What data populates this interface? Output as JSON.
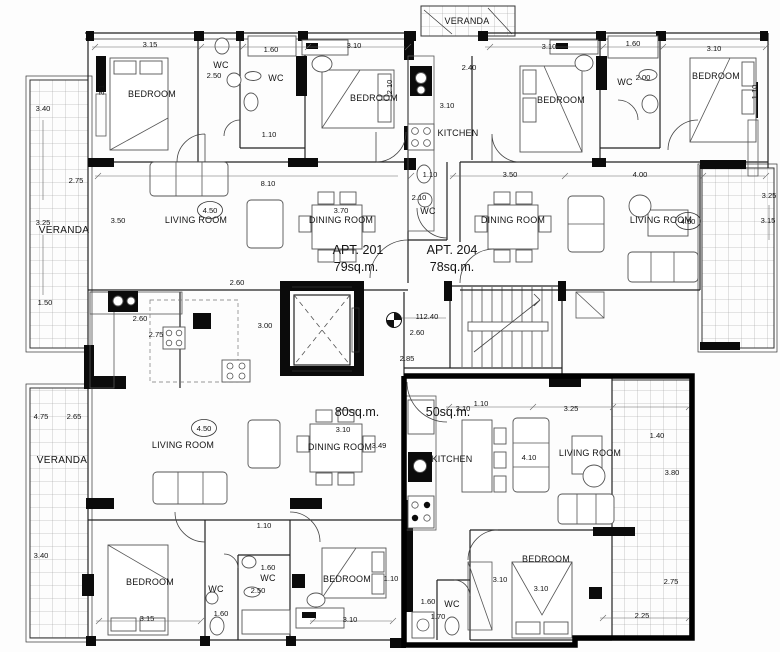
{
  "drawing": {
    "type": "architectural-floor-plan",
    "highlight_color": "#000000",
    "apartments": [
      {
        "id": "apt-201",
        "label": "APT. 201",
        "area": "79sq.m."
      },
      {
        "id": "apt-204",
        "label": "APT. 204",
        "area": "78sq.m."
      },
      {
        "id": "apt-bottom-left",
        "area": "80sq.m."
      },
      {
        "id": "apt-bottom-right",
        "area": "50sq.m.",
        "highlighted": true
      }
    ],
    "level_marker": {
      "value": "112.40"
    },
    "labels": [
      {
        "n": "bedroom-top-left",
        "t": "BEDROOM",
        "x": 152,
        "y": 97,
        "c": "room"
      },
      {
        "n": "wc-top-left",
        "t": "WC",
        "x": 221,
        "y": 68,
        "c": "room"
      },
      {
        "n": "wc-top-left-2",
        "t": "WC",
        "x": 276,
        "y": 81,
        "c": "room"
      },
      {
        "n": "bedroom-top-mid-left",
        "t": "BEDROOM",
        "x": 374,
        "y": 101,
        "c": "room"
      },
      {
        "n": "veranda-top",
        "t": "VERANDA",
        "x": 467,
        "y": 24,
        "c": "room"
      },
      {
        "n": "kitchen-top",
        "t": "KITCHEN",
        "x": 458,
        "y": 136,
        "c": "room"
      },
      {
        "n": "bedroom-top-mid-right",
        "t": "BEDROOM",
        "x": 561,
        "y": 103,
        "c": "room"
      },
      {
        "n": "wc-top-right",
        "t": "WC",
        "x": 625,
        "y": 85,
        "c": "room"
      },
      {
        "n": "bedroom-top-right",
        "t": "BEDROOM",
        "x": 716,
        "y": 79,
        "c": "room"
      },
      {
        "n": "veranda-left-top",
        "t": "VERANDA",
        "x": 64,
        "y": 233,
        "c": "ver"
      },
      {
        "n": "living-room-apt201",
        "t": "LIVING ROOM",
        "x": 196,
        "y": 223,
        "c": "room"
      },
      {
        "n": "dining-room-apt201",
        "t": "DINING ROOM",
        "x": 341,
        "y": 223,
        "c": "room"
      },
      {
        "n": "dining-room-apt204",
        "t": "DINING ROOM",
        "x": 513,
        "y": 223,
        "c": "room"
      },
      {
        "n": "living-room-apt204",
        "t": "LIVING ROOM",
        "x": 661,
        "y": 223,
        "c": "room"
      },
      {
        "n": "wc-apt204-hall",
        "t": "WC",
        "x": 428,
        "y": 214,
        "c": "room"
      },
      {
        "n": "veranda-left-bottom",
        "t": "VERANDA",
        "x": 62,
        "y": 463,
        "c": "ver"
      },
      {
        "n": "living-room-apt-bl",
        "t": "LIVING ROOM",
        "x": 183,
        "y": 448,
        "c": "room"
      },
      {
        "n": "dining-room-apt-bl",
        "t": "DINING ROOM",
        "x": 340,
        "y": 450,
        "c": "room"
      },
      {
        "n": "kitchen-apt-br",
        "t": "KITCHEN",
        "x": 452,
        "y": 462,
        "c": "room"
      },
      {
        "n": "living-room-apt-br",
        "t": "LIVING ROOM",
        "x": 590,
        "y": 456,
        "c": "room"
      },
      {
        "n": "bedroom-bottom-left",
        "t": "BEDROOM",
        "x": 150,
        "y": 585,
        "c": "room"
      },
      {
        "n": "wc-bottom-1",
        "t": "WC",
        "x": 216,
        "y": 592,
        "c": "room"
      },
      {
        "n": "wc-bottom-2",
        "t": "WC",
        "x": 268,
        "y": 581,
        "c": "room"
      },
      {
        "n": "bedroom-bottom-mid",
        "t": "BEDROOM",
        "x": 347,
        "y": 582,
        "c": "room"
      },
      {
        "n": "wc-bottom-3",
        "t": "WC",
        "x": 452,
        "y": 607,
        "c": "room"
      },
      {
        "n": "bedroom-bottom-right",
        "t": "BEDROOM",
        "x": 546,
        "y": 562,
        "c": "room"
      },
      {
        "n": "apt-201-label",
        "t": "APT. 201",
        "x": 358,
        "y": 254,
        "c": "apt"
      },
      {
        "n": "apt-201-area",
        "t": "79sq.m.",
        "x": 356,
        "y": 271,
        "c": "apt"
      },
      {
        "n": "apt-204-label",
        "t": "APT. 204",
        "x": 452,
        "y": 254,
        "c": "apt"
      },
      {
        "n": "apt-204-area",
        "t": "78sq.m.",
        "x": 452,
        "y": 271,
        "c": "apt"
      },
      {
        "n": "apt-bl-area",
        "t": "80sq.m.",
        "x": 357,
        "y": 416,
        "c": "apt"
      },
      {
        "n": "apt-br-area",
        "t": "50sq.m.",
        "x": 448,
        "y": 416,
        "c": "apt"
      },
      {
        "t": "3.15",
        "x": 150,
        "y": 47,
        "c": "dim"
      },
      {
        "t": "1.60",
        "x": 271,
        "y": 52,
        "c": "dim"
      },
      {
        "t": "3.10",
        "x": 354,
        "y": 48,
        "c": "dim"
      },
      {
        "t": "2.50",
        "x": 214,
        "y": 78,
        "c": "dim"
      },
      {
        "t": "2.40",
        "x": 469,
        "y": 70,
        "c": "dim"
      },
      {
        "t": "3.10",
        "x": 447,
        "y": 108,
        "c": "dim"
      },
      {
        "t": "2.10",
        "x": 392,
        "y": 87,
        "c": "dim",
        "r": -90
      },
      {
        "t": "3.1",
        "x": 104,
        "y": 90,
        "c": "dim",
        "r": -90
      },
      {
        "t": "3.10",
        "x": 549,
        "y": 49,
        "c": "dim"
      },
      {
        "t": "1.60",
        "x": 633,
        "y": 46,
        "c": "dim"
      },
      {
        "t": "2.00",
        "x": 643,
        "y": 80,
        "c": "dim"
      },
      {
        "t": "3.10",
        "x": 714,
        "y": 51,
        "c": "dim"
      },
      {
        "t": "1.10",
        "x": 757,
        "y": 92,
        "c": "dim",
        "r": -90
      },
      {
        "t": "3.40",
        "x": 43,
        "y": 111,
        "c": "dim"
      },
      {
        "t": "2.75",
        "x": 76,
        "y": 183,
        "c": "dim"
      },
      {
        "t": "3.25",
        "x": 43,
        "y": 225,
        "c": "dim"
      },
      {
        "t": "3.50",
        "x": 118,
        "y": 223,
        "c": "dim"
      },
      {
        "t": "1.50",
        "x": 45,
        "y": 305,
        "c": "dim"
      },
      {
        "t": "8.10",
        "x": 268,
        "y": 186,
        "c": "dim"
      },
      {
        "t": "1.10",
        "x": 269,
        "y": 137,
        "c": "dim"
      },
      {
        "t": "1.10",
        "x": 430,
        "y": 177,
        "c": "dim"
      },
      {
        "t": "3.50",
        "x": 510,
        "y": 177,
        "c": "dim"
      },
      {
        "t": "4.00",
        "x": 640,
        "y": 177,
        "c": "dim"
      },
      {
        "t": "2.10",
        "x": 419,
        "y": 200,
        "c": "dim"
      },
      {
        "t": "3.70",
        "x": 341,
        "y": 213,
        "c": "dim"
      },
      {
        "t": "4.50",
        "x": 210,
        "y": 213,
        "c": "dim",
        "o": 1
      },
      {
        "t": "4.50",
        "x": 688,
        "y": 224,
        "c": "dim",
        "o": 1
      },
      {
        "t": "3.25",
        "x": 769,
        "y": 198,
        "c": "dim"
      },
      {
        "t": "3.15",
        "x": 768,
        "y": 223,
        "c": "dim"
      },
      {
        "t": "2.60",
        "x": 237,
        "y": 285,
        "c": "dim"
      },
      {
        "t": "3.00",
        "x": 265,
        "y": 328,
        "c": "dim"
      },
      {
        "t": "2.60",
        "x": 140,
        "y": 321,
        "c": "dim"
      },
      {
        "t": "2.75",
        "x": 156,
        "y": 337,
        "c": "dim"
      },
      {
        "n": "level-value",
        "t": "112.40",
        "x": 427,
        "y": 319,
        "c": "dim"
      },
      {
        "t": "2.60",
        "x": 417,
        "y": 335,
        "c": "dim"
      },
      {
        "t": "2.85",
        "x": 407,
        "y": 361,
        "c": "dim"
      },
      {
        "t": "4.75",
        "x": 41,
        "y": 419,
        "c": "dim"
      },
      {
        "t": "2.65",
        "x": 74,
        "y": 419,
        "c": "dim"
      },
      {
        "t": "4.50",
        "x": 204,
        "y": 431,
        "c": "dim",
        "o": 1
      },
      {
        "t": "3.40",
        "x": 41,
        "y": 558,
        "c": "dim"
      },
      {
        "t": "3.10",
        "x": 343,
        "y": 432,
        "c": "dim"
      },
      {
        "t": "3.49",
        "x": 379,
        "y": 448,
        "c": "dim"
      },
      {
        "t": "3.10",
        "x": 463,
        "y": 411,
        "c": "dim"
      },
      {
        "t": "1.10",
        "x": 481,
        "y": 406,
        "c": "dim"
      },
      {
        "t": "3.25",
        "x": 571,
        "y": 411,
        "c": "dim"
      },
      {
        "t": "4.10",
        "x": 529,
        "y": 460,
        "c": "dim"
      },
      {
        "t": "1.40",
        "x": 657,
        "y": 438,
        "c": "dim"
      },
      {
        "t": "3.80",
        "x": 672,
        "y": 475,
        "c": "dim"
      },
      {
        "t": "1.10",
        "x": 264,
        "y": 528,
        "c": "dim"
      },
      {
        "t": "3.15",
        "x": 147,
        "y": 621,
        "c": "dim"
      },
      {
        "t": "1.60",
        "x": 221,
        "y": 616,
        "c": "dim"
      },
      {
        "t": "1.60",
        "x": 268,
        "y": 570,
        "c": "dim"
      },
      {
        "t": "2.50",
        "x": 258,
        "y": 593,
        "c": "dim"
      },
      {
        "t": "3.10",
        "x": 350,
        "y": 622,
        "c": "dim"
      },
      {
        "t": "1.10",
        "x": 391,
        "y": 581,
        "c": "dim"
      },
      {
        "t": "3.10",
        "x": 500,
        "y": 582,
        "c": "dim"
      },
      {
        "t": "3.10",
        "x": 541,
        "y": 591,
        "c": "dim"
      },
      {
        "t": "1.60",
        "x": 428,
        "y": 604,
        "c": "dim"
      },
      {
        "t": "1.70",
        "x": 438,
        "y": 619,
        "c": "dim"
      },
      {
        "t": "2.75",
        "x": 671,
        "y": 584,
        "c": "dim"
      },
      {
        "t": "2.25",
        "x": 642,
        "y": 618,
        "c": "dim"
      }
    ]
  }
}
